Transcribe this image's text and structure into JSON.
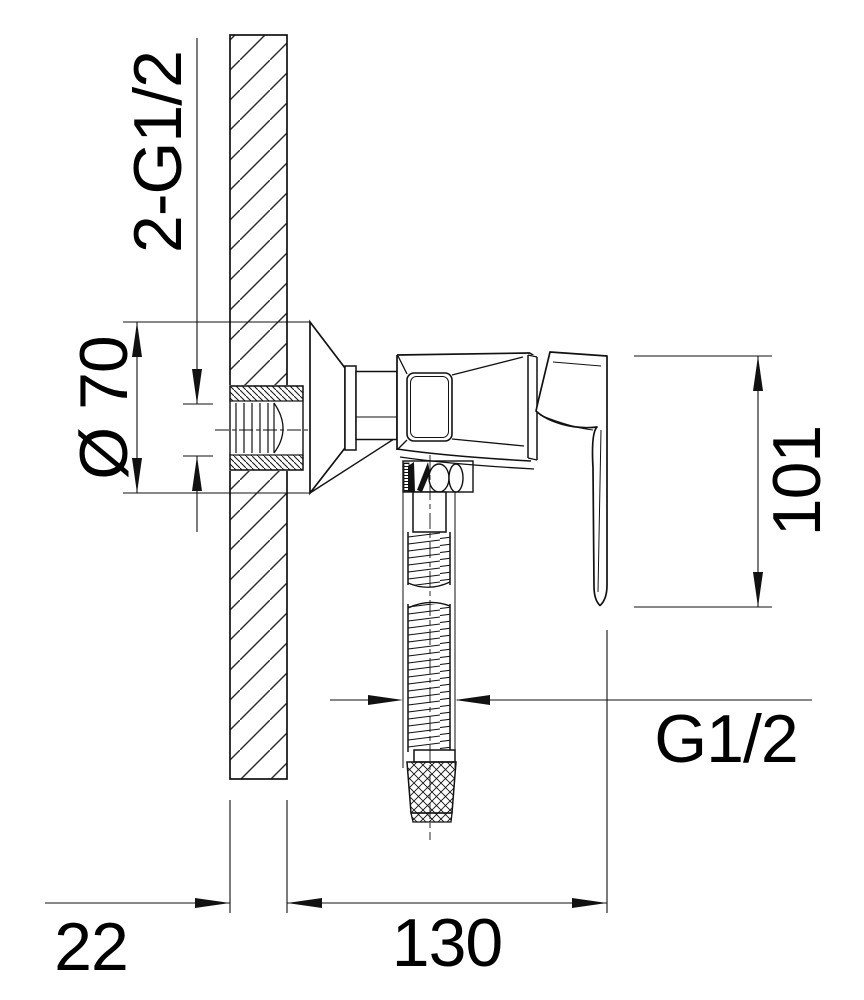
{
  "drawing": {
    "type": "technical-installation-drawing",
    "subject": "wall-mounted shower mixer, side section view",
    "background": "#ffffff",
    "line_color": "#111111",
    "labels": {
      "wall_connections_thread": "2-G1/2",
      "escutcheon_diameter": "Ø 70",
      "valve_height": "101",
      "hose_thread": "G1/2",
      "wall_thickness": "22",
      "valve_depth": "130"
    }
  }
}
